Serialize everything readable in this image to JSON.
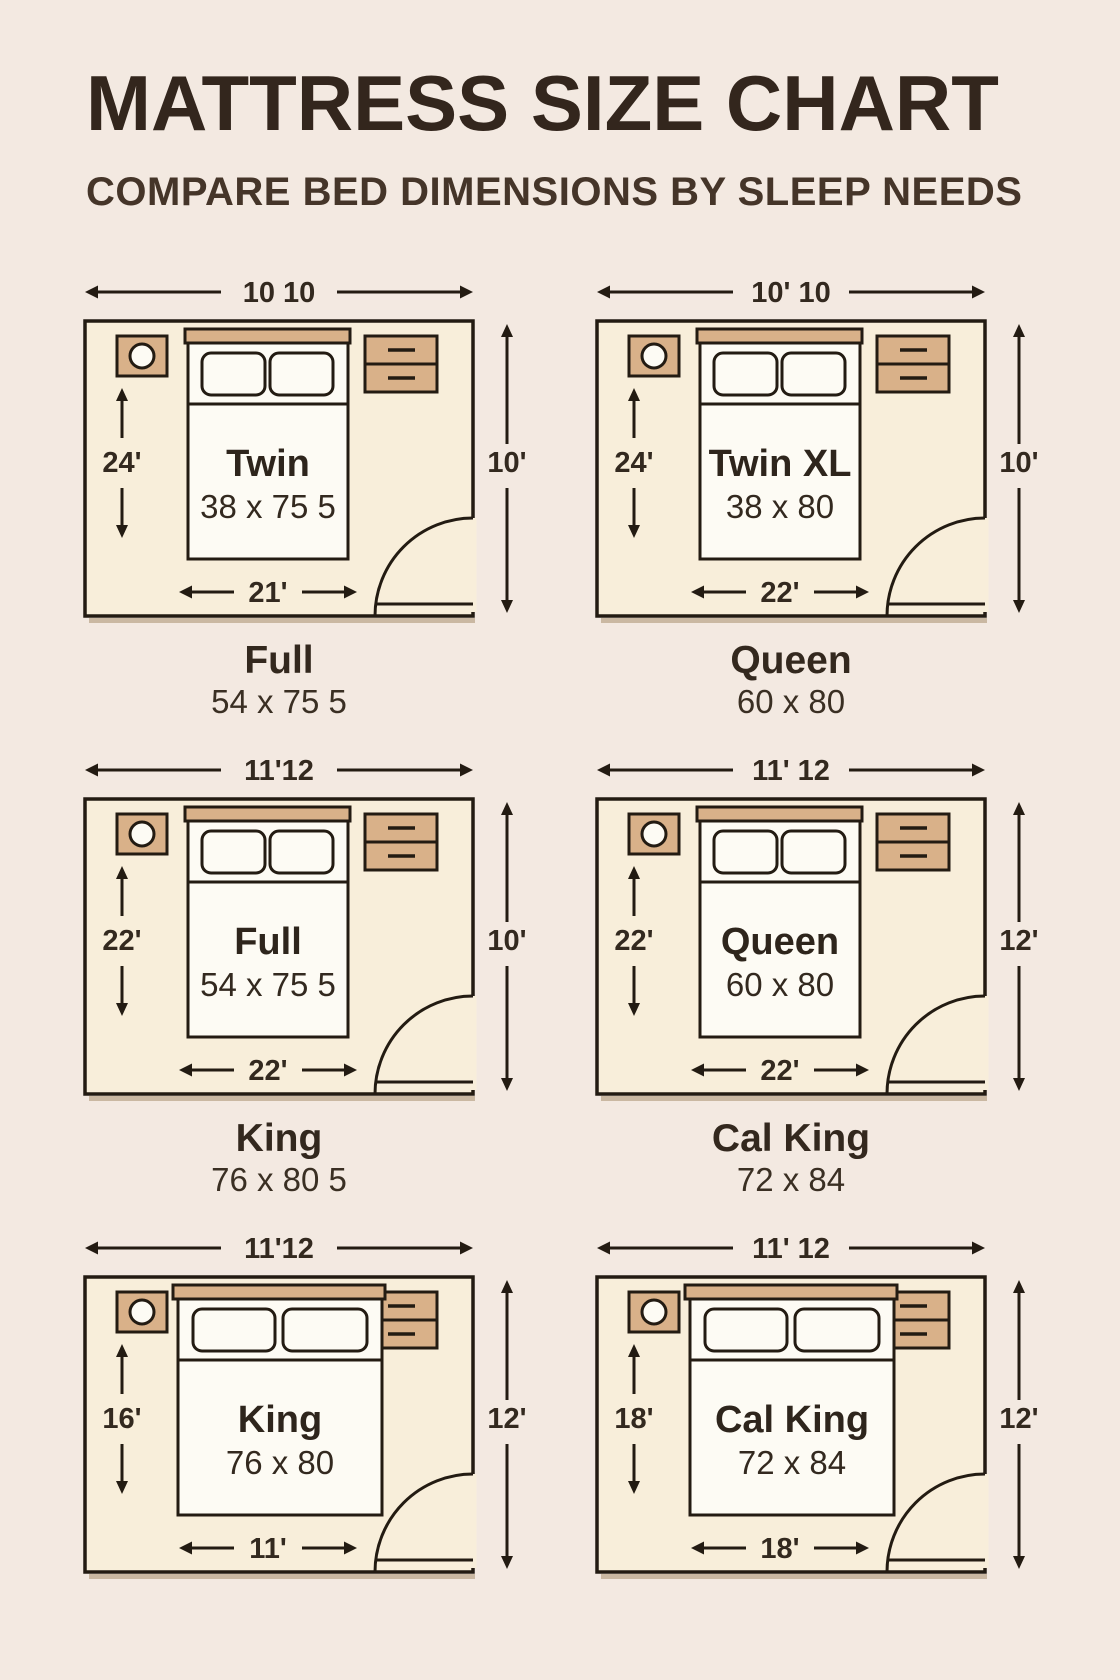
{
  "header": {
    "title": "MATTRESS SIZE CHART",
    "subtitle": "COMPARE BED DIMENSIONS BY SLEEP NEEDS"
  },
  "rooms": [
    {
      "bed_name": "Twin",
      "bed_size": "38 x 75 5",
      "top_width": "10 10",
      "left_height": "24'",
      "right_height": "10'",
      "bed_width": "21'",
      "wide_bed": false
    },
    {
      "bed_name": "Twin XL",
      "bed_size": "38 x 80",
      "top_width": "10' 10",
      "left_height": "24'",
      "right_height": "10'",
      "bed_width": "22'",
      "wide_bed": false
    },
    {
      "bed_name": "Full",
      "bed_size": "54 x 75 5",
      "top_width": "11'12",
      "left_height": "22'",
      "right_height": "10'",
      "bed_width": "22'",
      "wide_bed": false
    },
    {
      "bed_name": "Queen",
      "bed_size": "60 x 80",
      "top_width": "11' 12",
      "left_height": "22'",
      "right_height": "12'",
      "bed_width": "22'",
      "wide_bed": false
    },
    {
      "bed_name": "King",
      "bed_size": "76 x 80",
      "top_width": "11'12",
      "left_height": "16'",
      "right_height": "12'",
      "bed_width": "11'",
      "wide_bed": true
    },
    {
      "bed_name": "Cal King",
      "bed_size": "72 x 84",
      "top_width": "11' 12",
      "left_height": "18'",
      "right_height": "12'",
      "bed_width": "18'",
      "wide_bed": true
    }
  ],
  "captions": [
    {
      "name": "Full",
      "size": "54 x 75 5"
    },
    {
      "name": "Queen",
      "size": "60 x 80"
    },
    {
      "name": "King",
      "size": "76 x 80 5"
    },
    {
      "name": "Cal King",
      "size": "72 x 84"
    }
  ],
  "colors": {
    "background": "#f3e9e1",
    "room_fill": "#f8eeda",
    "furniture_tan": "#d9b189",
    "outline": "#231b12",
    "title_text": "#33261d",
    "label_text": "#33291f"
  }
}
